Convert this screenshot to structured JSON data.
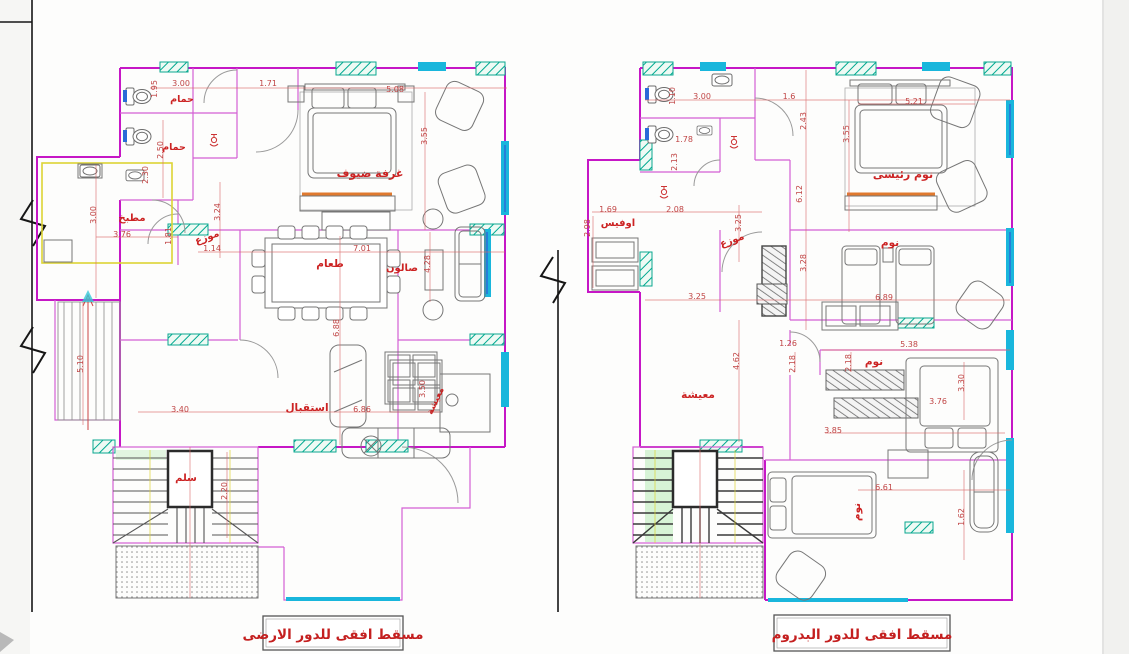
{
  "titles": {
    "ground_floor": "مسقط افقى للدور الارضى",
    "basement": "مسقط افقى للدور البدروم"
  },
  "colors": {
    "wall": "#c617c6",
    "room_label": "#cc2323",
    "dimension_text": "#c04545",
    "window": "#19b6dc",
    "hatch": "#0aa890",
    "furniture": "#767676",
    "stair_core": "#2b2b2b",
    "accent_yellow": "#ddd435",
    "accent_orange": "#e0792e",
    "accent_blue": "#2a6bd8",
    "paper": "#ffffff"
  },
  "left_plan": {
    "name": "ground-floor-plan",
    "rooms": [
      {
        "label": "حمام",
        "x": 182,
        "y": 102,
        "s": 9.5
      },
      {
        "label": "حمام",
        "x": 174,
        "y": 150,
        "s": 9.5
      },
      {
        "label": "غرفة ضيوف",
        "x": 370,
        "y": 177,
        "s": 11
      },
      {
        "label": "مطبخ",
        "x": 132,
        "y": 221,
        "s": 10
      },
      {
        "label": "موزع",
        "x": 208,
        "y": 240,
        "s": 10,
        "r": -20
      },
      {
        "label": "طعام",
        "x": 330,
        "y": 267,
        "s": 10.5
      },
      {
        "label": "صالون",
        "x": 402,
        "y": 271,
        "s": 10
      },
      {
        "label": "استقبال",
        "x": 307,
        "y": 411,
        "s": 10.5
      },
      {
        "label": "معيشة",
        "x": 438,
        "y": 402,
        "s": 9,
        "r": -65
      },
      {
        "label": "سلم",
        "x": 186,
        "y": 481,
        "s": 10
      }
    ],
    "dims": [
      {
        "v": "3.00",
        "x": 181,
        "y": 86
      },
      {
        "v": "1.95",
        "x": 157,
        "y": 89,
        "r": -90
      },
      {
        "v": "1.71",
        "x": 268,
        "y": 86
      },
      {
        "v": "5.08",
        "x": 395,
        "y": 92
      },
      {
        "v": "3.55",
        "x": 427,
        "y": 136,
        "r": -90
      },
      {
        "v": "2.50",
        "x": 163,
        "y": 150,
        "r": -90
      },
      {
        "v": "2.30",
        "x": 148,
        "y": 175,
        "r": -90
      },
      {
        "v": "3.24",
        "x": 220,
        "y": 212,
        "r": -90
      },
      {
        "v": "1.14",
        "x": 212,
        "y": 251
      },
      {
        "v": "3.00",
        "x": 96,
        "y": 215,
        "r": -90
      },
      {
        "v": "3.76",
        "x": 122,
        "y": 237
      },
      {
        "v": "1.81",
        "x": 171,
        "y": 236,
        "r": -90
      },
      {
        "v": "7.01",
        "x": 362,
        "y": 251
      },
      {
        "v": "6.88",
        "x": 339,
        "y": 328,
        "r": -90
      },
      {
        "v": "4.28",
        "x": 430,
        "y": 264,
        "r": -90
      },
      {
        "v": "3.40",
        "x": 180,
        "y": 412
      },
      {
        "v": "6.86",
        "x": 362,
        "y": 412
      },
      {
        "v": "3.50",
        "x": 425,
        "y": 389,
        "r": -90
      },
      {
        "v": "2.20",
        "x": 227,
        "y": 491,
        "r": -90
      },
      {
        "v": "5.10",
        "x": 83,
        "y": 364,
        "r": -90
      }
    ]
  },
  "right_plan": {
    "name": "basement-floor-plan",
    "rooms": [
      {
        "label": "اوفيس",
        "x": 618,
        "y": 226,
        "s": 10
      },
      {
        "label": "نوم رئيسى",
        "x": 903,
        "y": 178,
        "s": 11
      },
      {
        "label": "موزع",
        "x": 733,
        "y": 243,
        "s": 10,
        "r": -20
      },
      {
        "label": "نوم",
        "x": 890,
        "y": 246,
        "s": 10.5
      },
      {
        "label": "معيشة",
        "x": 698,
        "y": 398,
        "s": 10.5
      },
      {
        "label": "نوم",
        "x": 874,
        "y": 365,
        "s": 10.5
      },
      {
        "label": "نوم",
        "x": 860,
        "y": 512,
        "s": 10.5,
        "r": -90
      }
    ],
    "dims": [
      {
        "v": "1.10",
        "x": 675,
        "y": 96,
        "r": -90
      },
      {
        "v": "3.00",
        "x": 702,
        "y": 99
      },
      {
        "v": "1.6",
        "x": 789,
        "y": 99
      },
      {
        "v": "2.43",
        "x": 806,
        "y": 121,
        "r": -90
      },
      {
        "v": "1.78",
        "x": 684,
        "y": 142
      },
      {
        "v": "2.13",
        "x": 677,
        "y": 162,
        "r": -90
      },
      {
        "v": "2.08",
        "x": 675,
        "y": 212
      },
      {
        "v": "1.69",
        "x": 608,
        "y": 212
      },
      {
        "v": "2.98",
        "x": 590,
        "y": 228,
        "r": -90
      },
      {
        "v": "3.25",
        "x": 741,
        "y": 223,
        "r": -90
      },
      {
        "v": "3.25",
        "x": 697,
        "y": 299
      },
      {
        "v": "3.28",
        "x": 806,
        "y": 263,
        "r": -90
      },
      {
        "v": "5.21",
        "x": 914,
        "y": 104
      },
      {
        "v": "3.55",
        "x": 849,
        "y": 134,
        "r": -90
      },
      {
        "v": "6.12",
        "x": 802,
        "y": 194,
        "r": -90
      },
      {
        "v": "6.89",
        "x": 884,
        "y": 300
      },
      {
        "v": "5.38",
        "x": 909,
        "y": 347
      },
      {
        "v": "1.26",
        "x": 788,
        "y": 346
      },
      {
        "v": "2.18",
        "x": 795,
        "y": 364,
        "r": -90
      },
      {
        "v": "2.18",
        "x": 851,
        "y": 363,
        "r": -90
      },
      {
        "v": "4.62",
        "x": 739,
        "y": 361,
        "r": -90
      },
      {
        "v": "3.30",
        "x": 964,
        "y": 383,
        "r": -90
      },
      {
        "v": "3.76",
        "x": 938,
        "y": 404
      },
      {
        "v": "3.85",
        "x": 833,
        "y": 433
      },
      {
        "v": "6.61",
        "x": 884,
        "y": 490
      },
      {
        "v": "1.62",
        "x": 964,
        "y": 517,
        "r": -90
      }
    ]
  }
}
